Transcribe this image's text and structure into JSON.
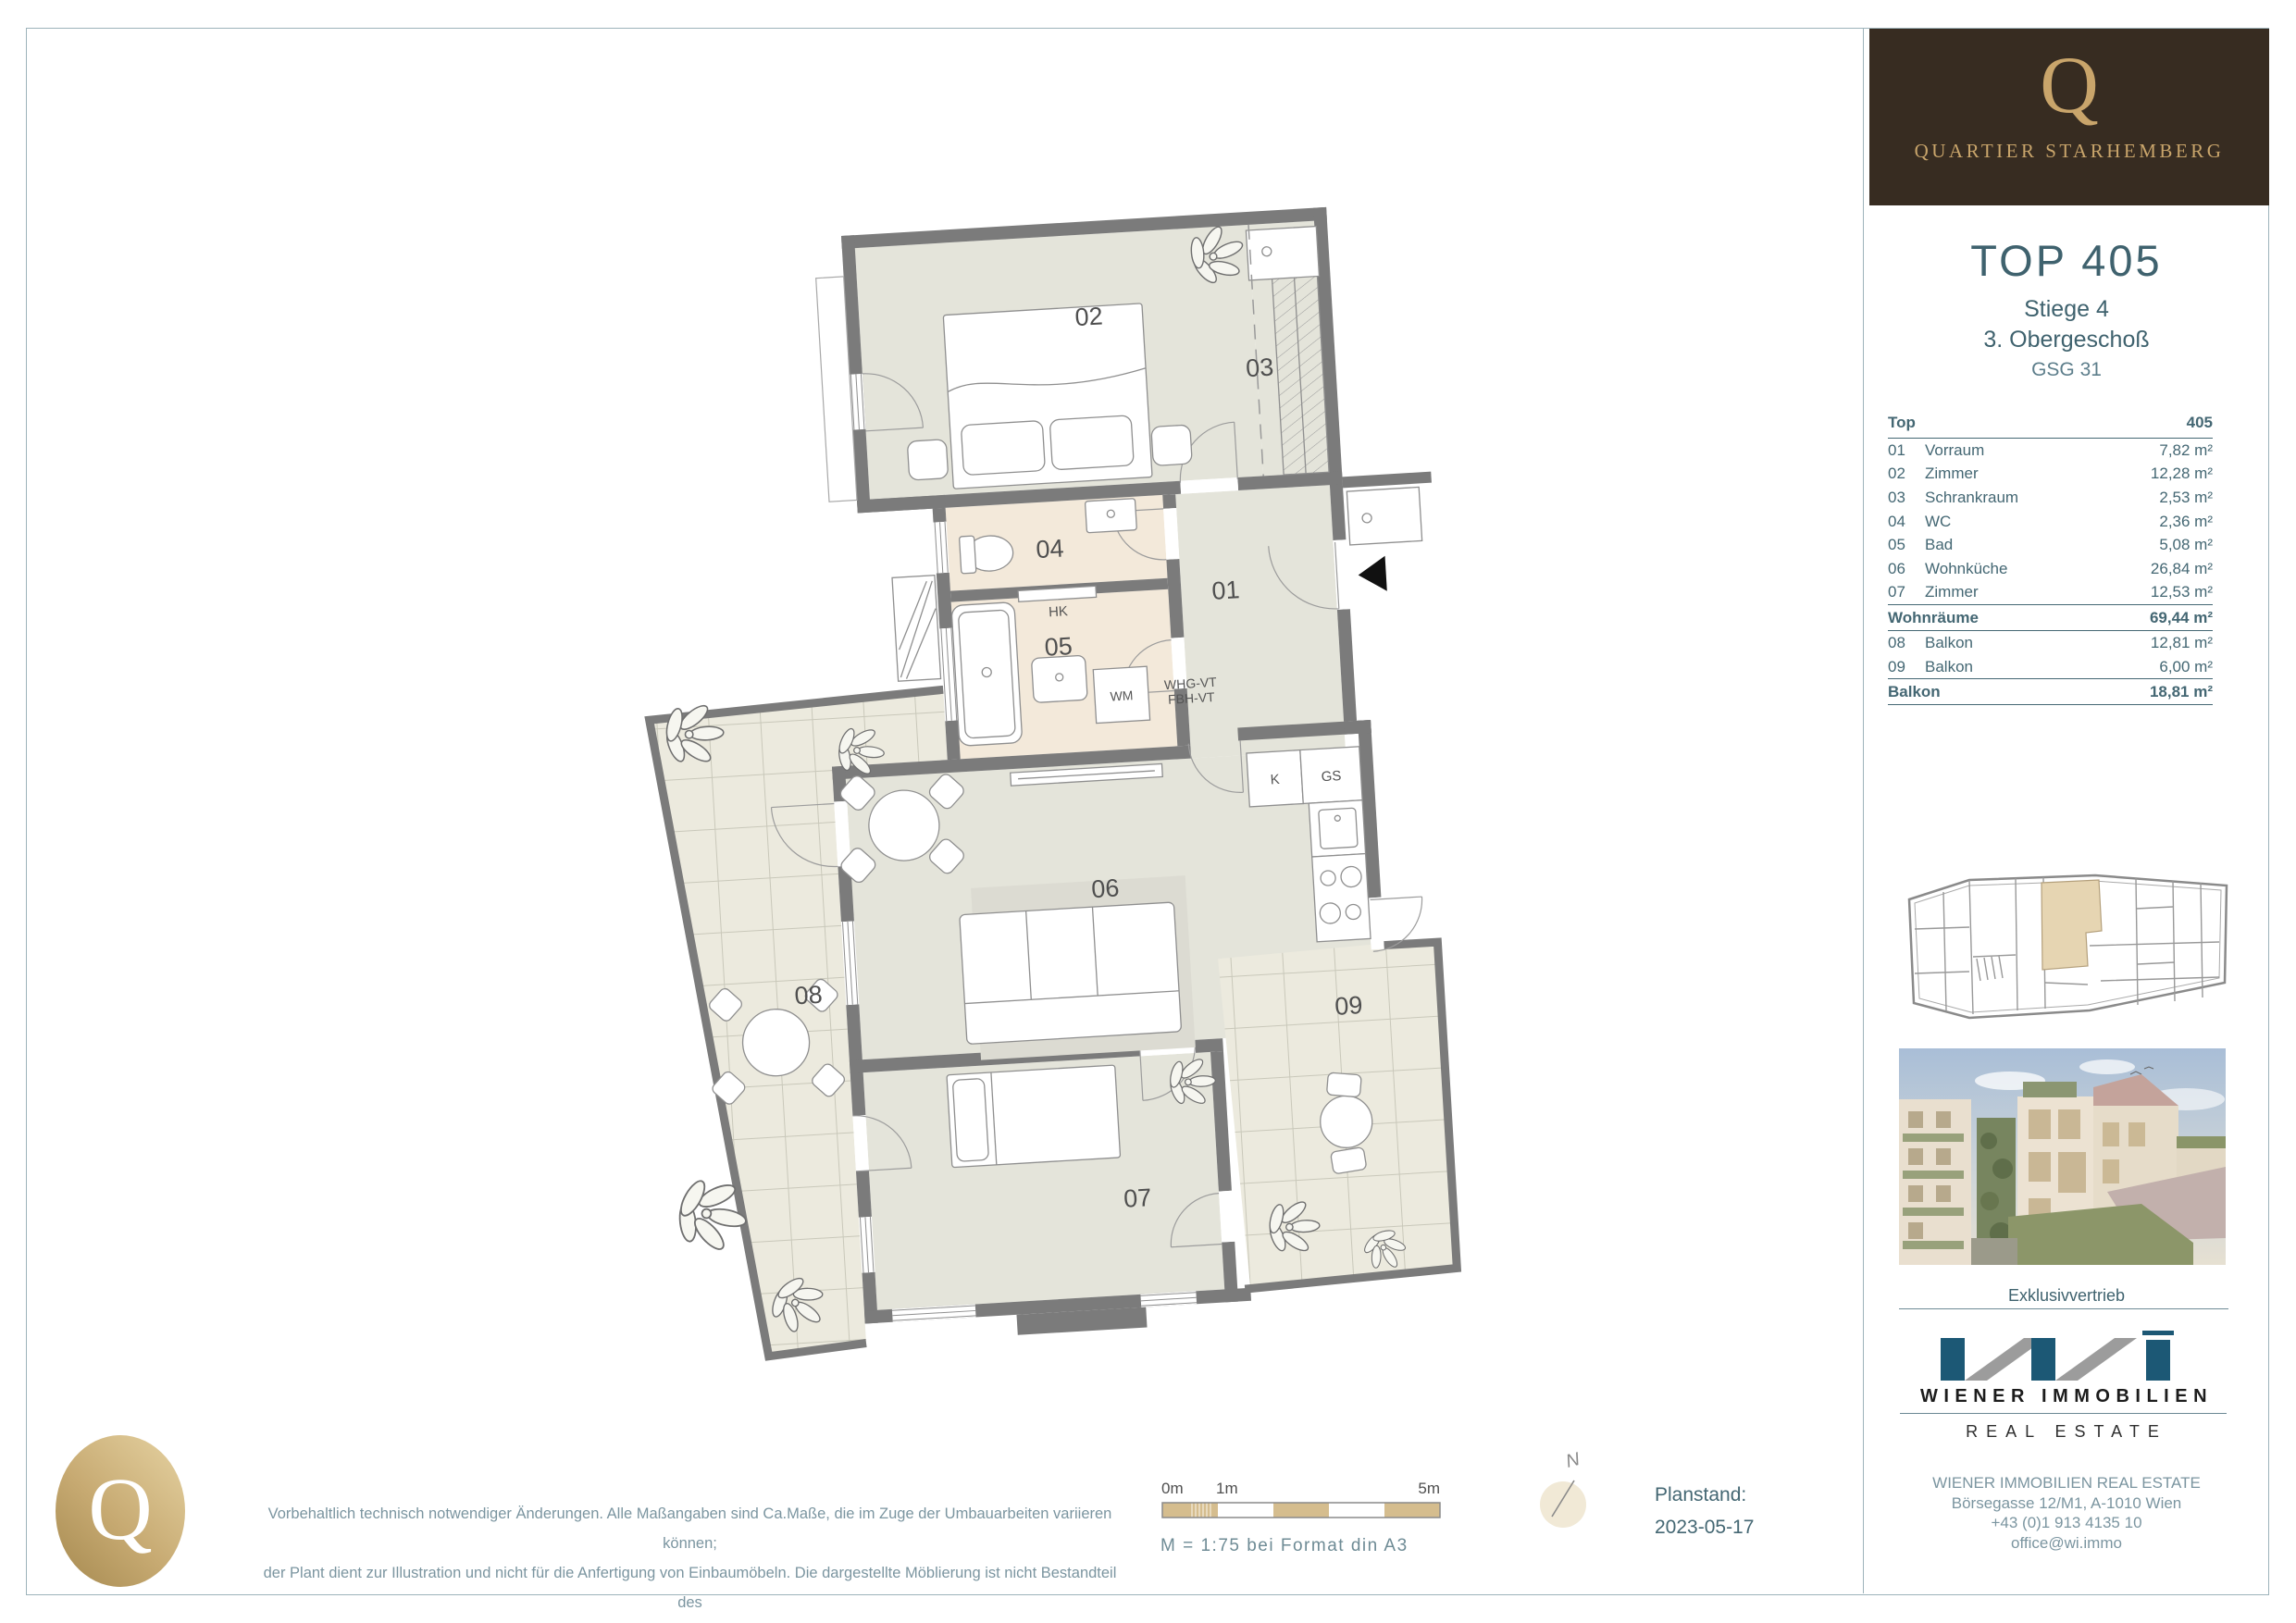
{
  "brand": {
    "logo_letter": "Q",
    "name": "QUARTIER STARHEMBERG"
  },
  "unit": {
    "title": "TOP 405",
    "line1": "Stiege 4",
    "line2": "3. Obergeschoß",
    "line3": "GSG 31"
  },
  "area_table": {
    "header_label": "Top",
    "header_value": "405",
    "rows": [
      {
        "nr": "01",
        "name": "Vorraum",
        "value": "7,82 m²"
      },
      {
        "nr": "02",
        "name": "Zimmer",
        "value": "12,28 m²"
      },
      {
        "nr": "03",
        "name": "Schrankraum",
        "value": "2,53 m²"
      },
      {
        "nr": "04",
        "name": "WC",
        "value": "2,36 m²"
      },
      {
        "nr": "05",
        "name": "Bad",
        "value": "5,08 m²"
      },
      {
        "nr": "06",
        "name": "Wohnküche",
        "value": "26,84 m²"
      },
      {
        "nr": "07",
        "name": "Zimmer",
        "value": "12,53 m²"
      }
    ],
    "subtotal1": {
      "name": "Wohnräume",
      "value": "69,44 m²"
    },
    "rows2": [
      {
        "nr": "08",
        "name": "Balkon",
        "value": "12,81 m²"
      },
      {
        "nr": "09",
        "name": "Balkon",
        "value": "6,00 m²"
      }
    ],
    "subtotal2": {
      "name": "Balkon",
      "value": "18,81 m²"
    }
  },
  "plan": {
    "labels": {
      "r01": "01",
      "r02": "02",
      "r03": "03",
      "r04": "04",
      "r05": "05",
      "r06": "06",
      "r07": "07",
      "r08": "08",
      "r09": "09"
    },
    "annotations": {
      "hk": "HK",
      "wm": "WM",
      "k": "K",
      "gs": "GS",
      "vt1": "WHG-VT",
      "vt2": "FBH-VT"
    }
  },
  "footer": {
    "disclaimer_lines": [
      "Vorbehaltlich technisch notwendiger Änderungen. Alle Maßangaben sind Ca.Maße, die im Zuge der Umbauarbeiten variieren können;",
      "der Plant dient zur Illustration und nicht für die Anfertigung von Einbaumöbeln. Die dargestellte Möblierung ist nicht Bestandteil des",
      "Lieferumfanges und dient nur als Einrichtungsvorschlag. Alle dargestellten Gegenstände haben symbolhaften Charakter."
    ],
    "scale_labels": {
      "zero": "0m",
      "one": "1m",
      "five": "5m"
    },
    "scale_text": "M = 1:75 bei Format din A3",
    "north_label": "N",
    "planstand_label": "Planstand:",
    "planstand_date": "2023-05-17"
  },
  "distribution": {
    "label": "Exklusivvertrieb",
    "logo_name": "WIENER IMMOBILIEN",
    "logo_sub": "REAL ESTATE",
    "contact_lines": [
      "WIENER IMMOBILIEN REAL ESTATE",
      "Börsegasse 12/M1, A-1010 Wien",
      "+43 (0)1 913 4135 10",
      "office@wi.immo"
    ]
  },
  "colors": {
    "accent_teal": "#3f626e",
    "gold": "#c9a56b",
    "brown": "#372c21",
    "wall_gray": "#7b7b7b",
    "wi_blue": "#1c5875",
    "floor_green": "#e4e4da",
    "floor_beige": "#f3e9da",
    "balcony": "#eceade",
    "scale_tan": "#d5bd8e"
  }
}
